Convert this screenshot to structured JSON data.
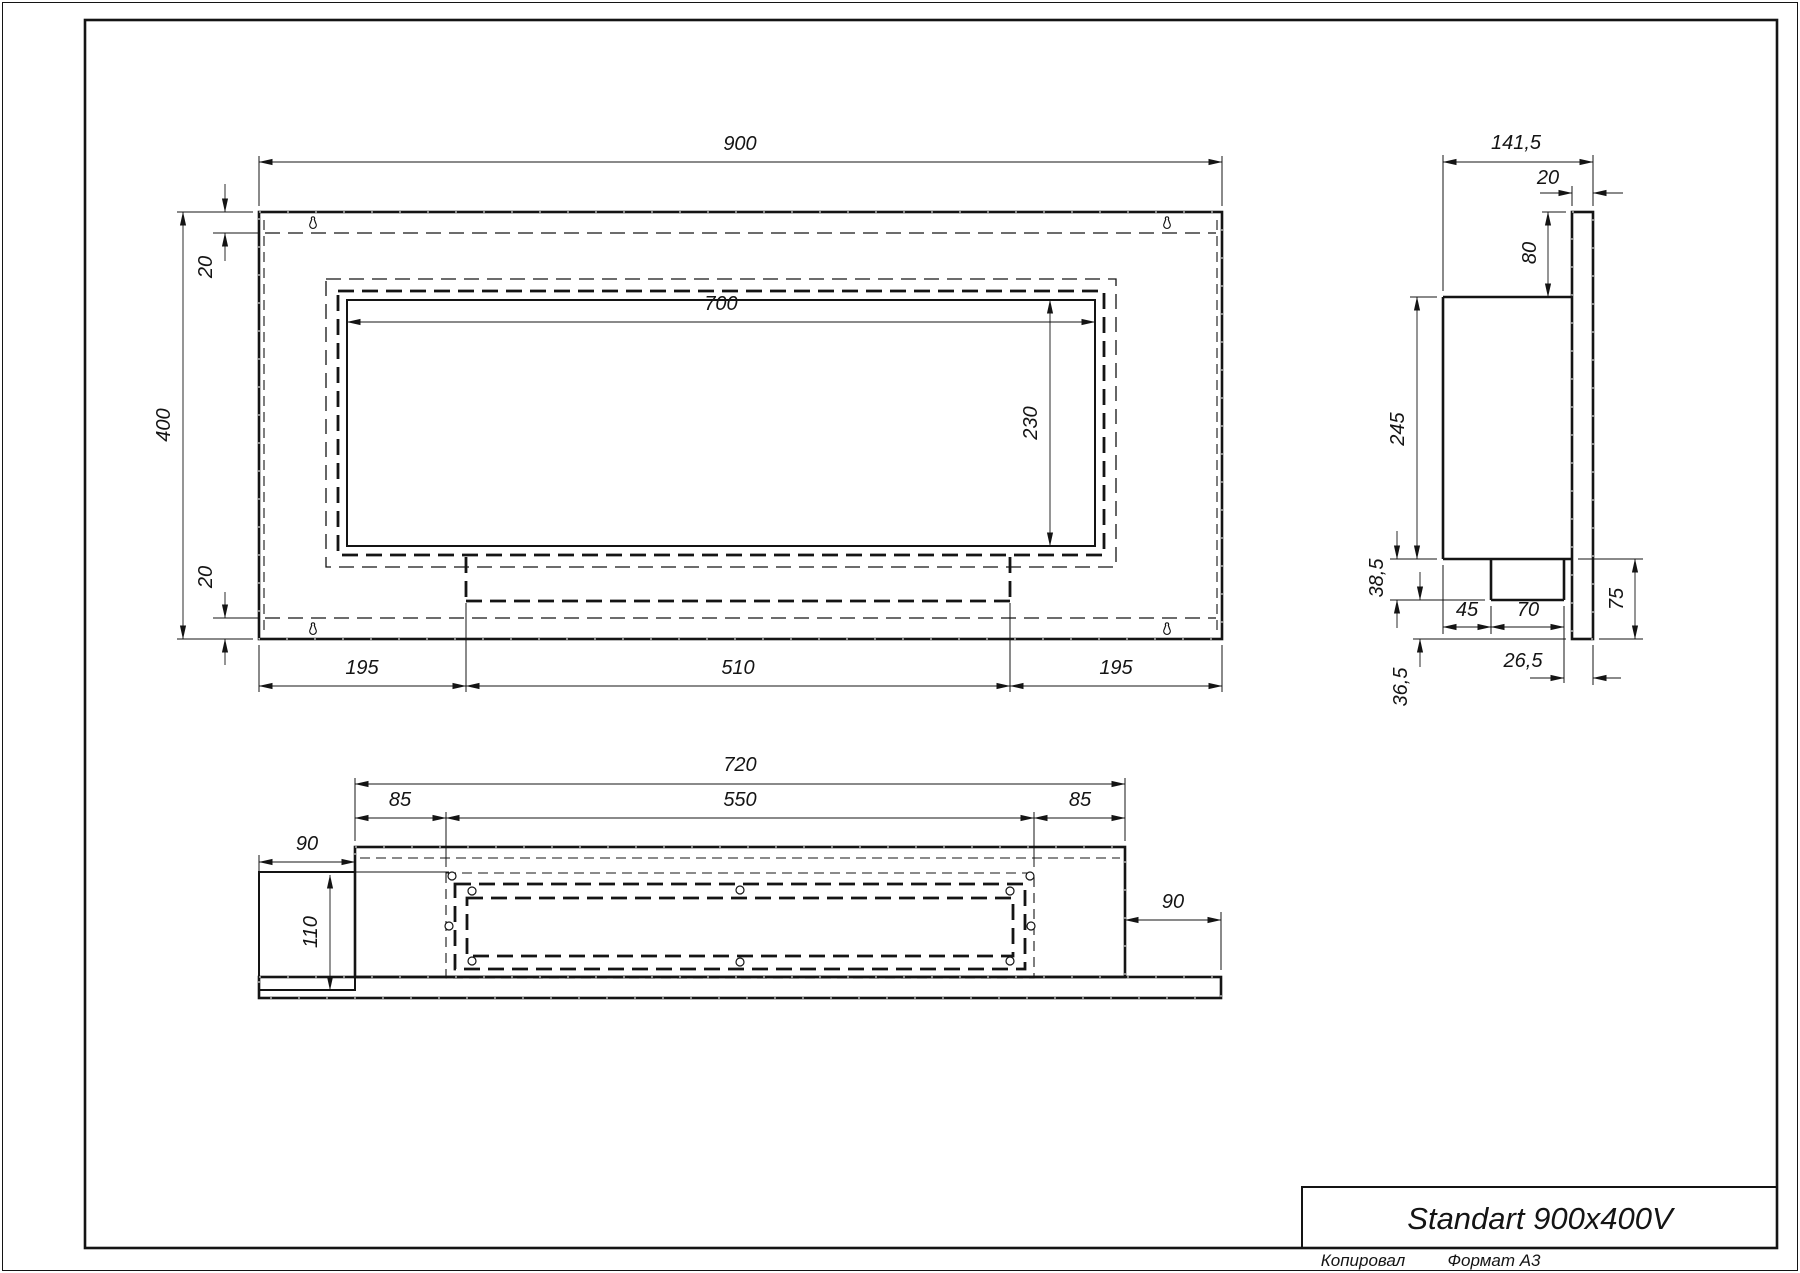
{
  "title_block": {
    "title": "Standart 900x400V"
  },
  "footer": {
    "copied": "Копировал",
    "format": "Формат А3"
  },
  "front": {
    "width": "900",
    "height": "400",
    "top_inset": "20",
    "bottom_inset": "20",
    "opening_width": "700",
    "opening_height": "230",
    "left": "195",
    "center": "510",
    "right": "195"
  },
  "side": {
    "depth": "141,5",
    "panel": "20",
    "top_gap": "80",
    "body": "245",
    "burner_depth": "38,5",
    "bottom_gap": "36,5",
    "front": "45",
    "burner_width": "70",
    "back": "26,5",
    "drop": "75"
  },
  "bottom": {
    "width": "720",
    "left": "85",
    "opening": "550",
    "right": "85",
    "side_left": "90",
    "side_right": "90",
    "depth": "110"
  }
}
